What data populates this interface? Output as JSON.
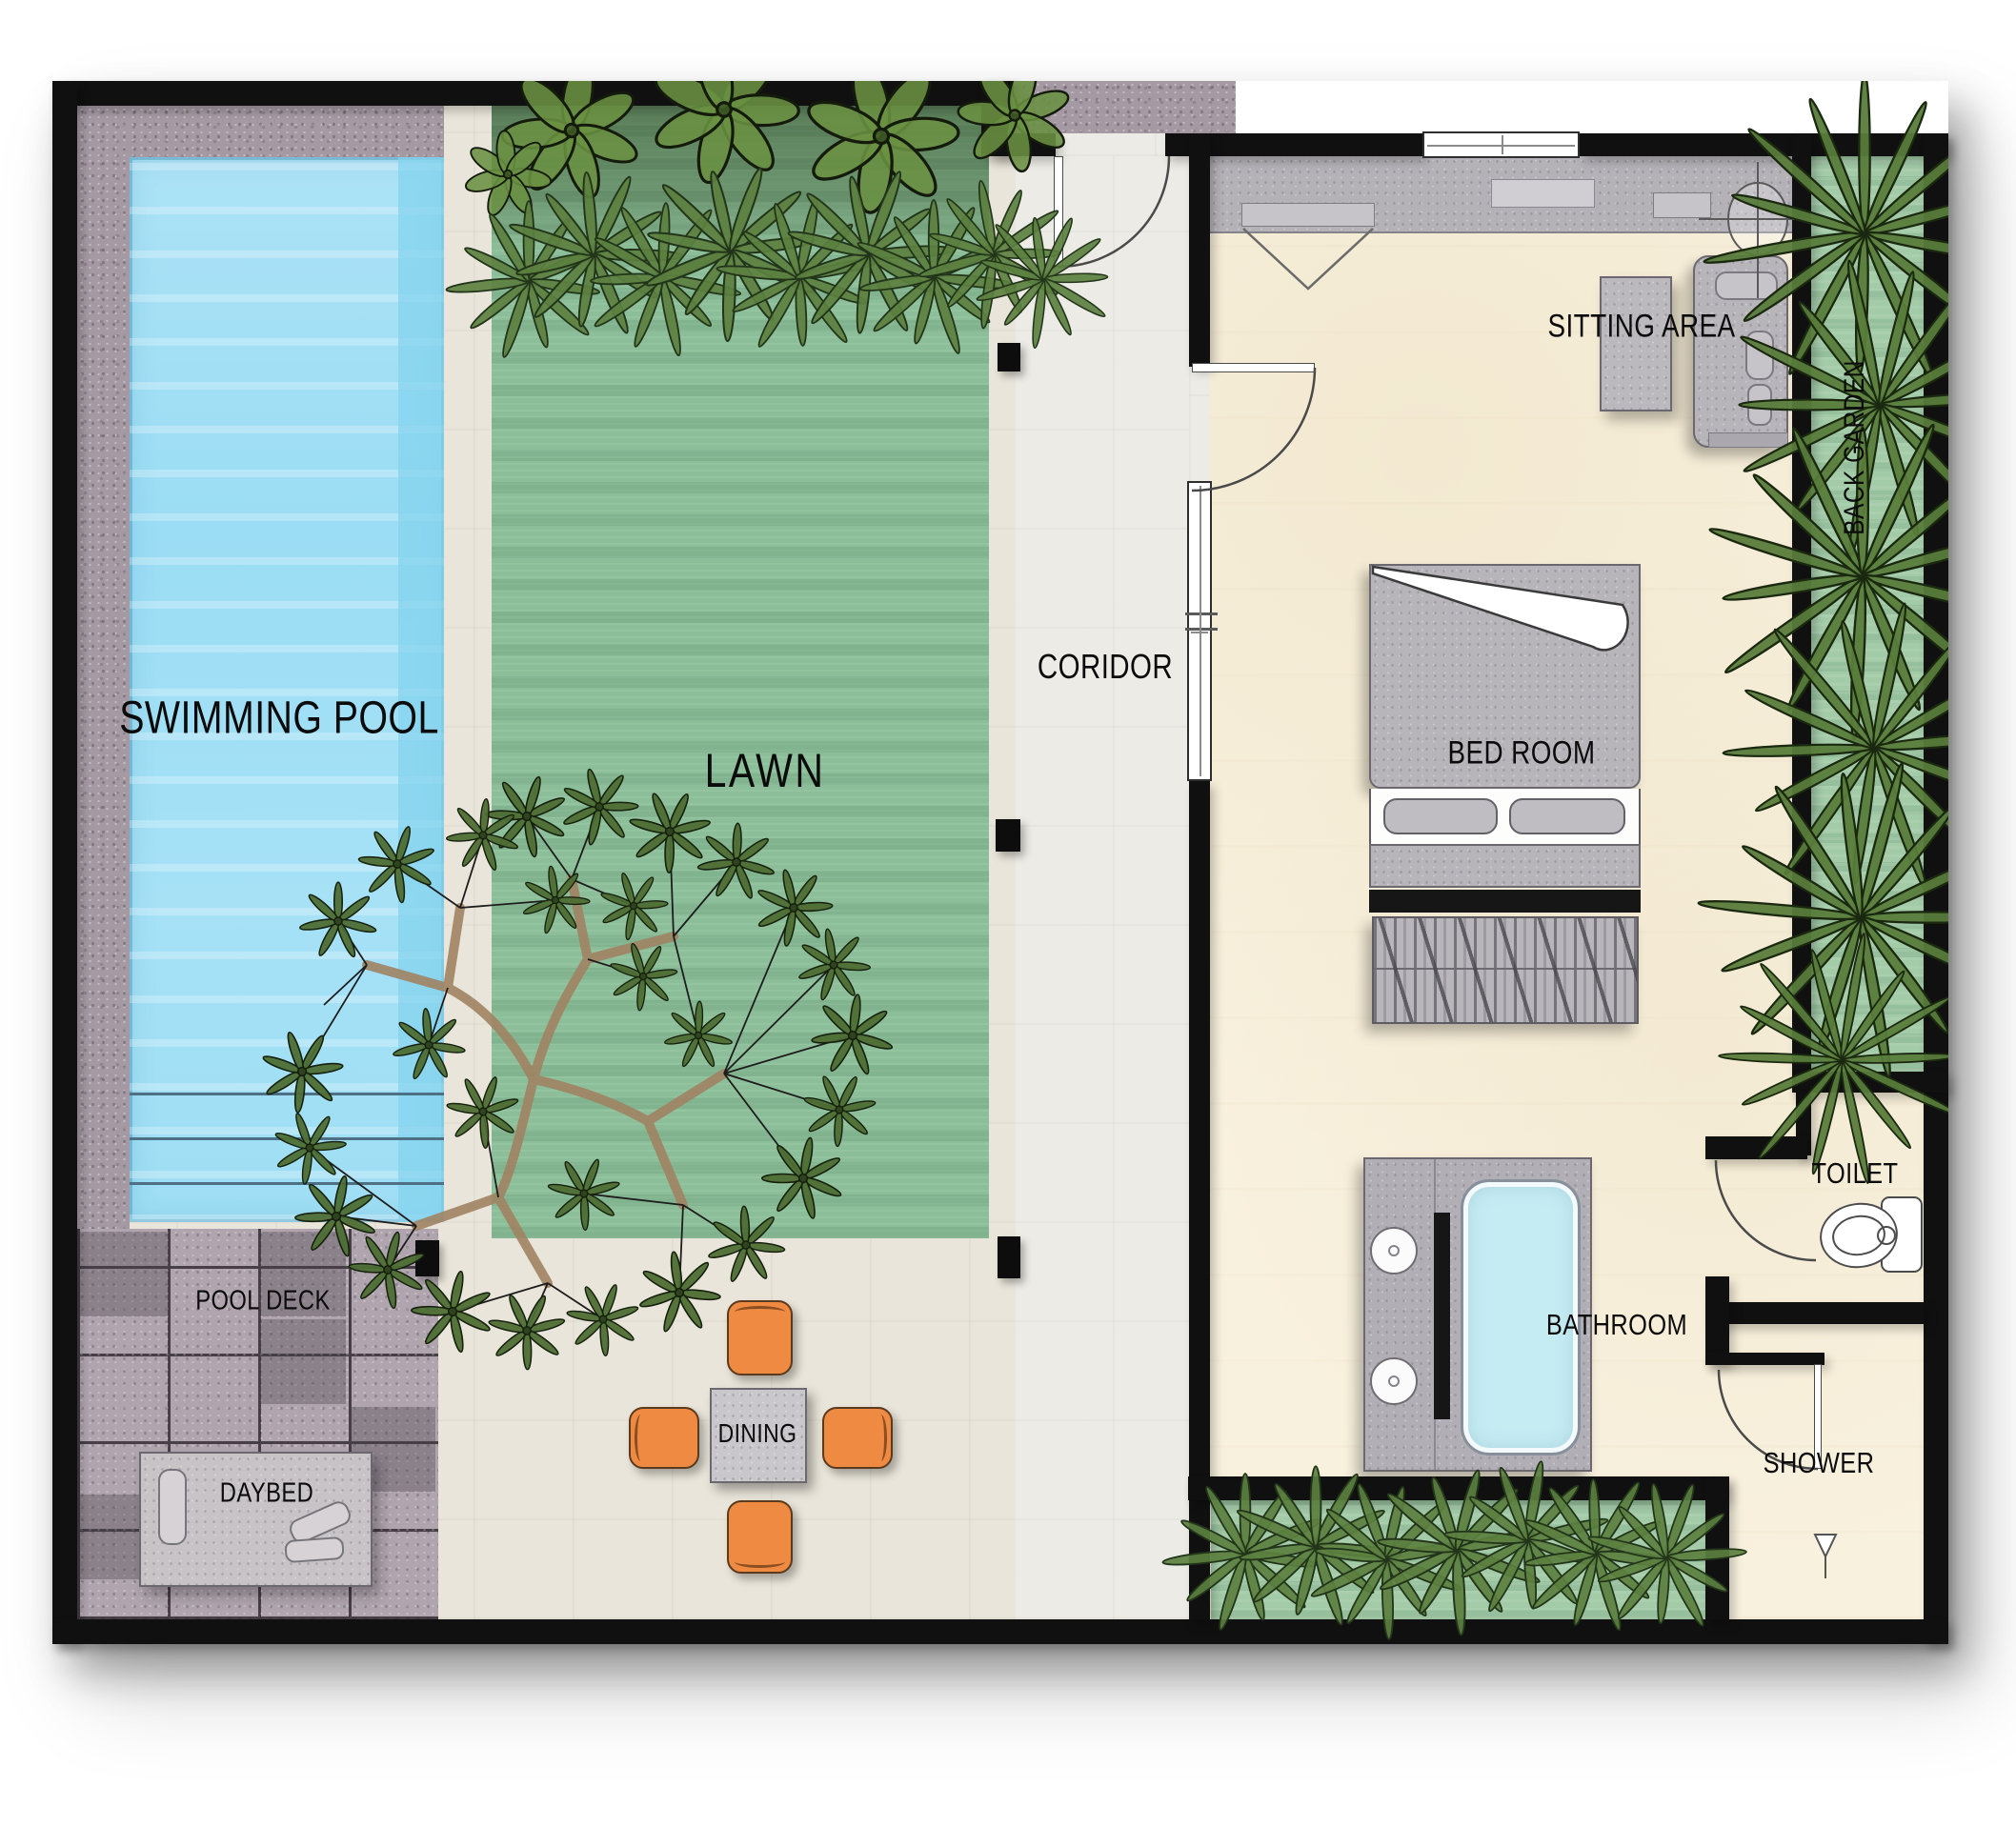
{
  "plan": {
    "type": "villa-floor-plan",
    "rooms": {
      "swimming_pool": "SWIMMING POOL",
      "lawn": "LAWN",
      "coridor": "CORIDOR",
      "sitting_area": "SITTING AREA",
      "bed_room": "BED ROOM",
      "back_garden": "BACK GARDEN",
      "toilet": "TOILET",
      "bathroom": "BATHROOM",
      "shower": "SHOWER",
      "dining": "DINING",
      "pool_deck": "POOL DECK",
      "daybed": "DAYBED"
    },
    "colors": {
      "wall": "#111010",
      "pool_water": "#9edef4",
      "tub_water": "#c5ebf3",
      "lawn_green": "#8cbf99",
      "garden_green": "#a3cba8",
      "plant_olive": "#5c8040",
      "stone_deck": "#a59aa3",
      "hardscape": "#e9e5da",
      "bedroom_floor": "#f8f1de",
      "furniture_gray": "#b7b5ba",
      "chair_orange": "#ef8a43"
    }
  }
}
